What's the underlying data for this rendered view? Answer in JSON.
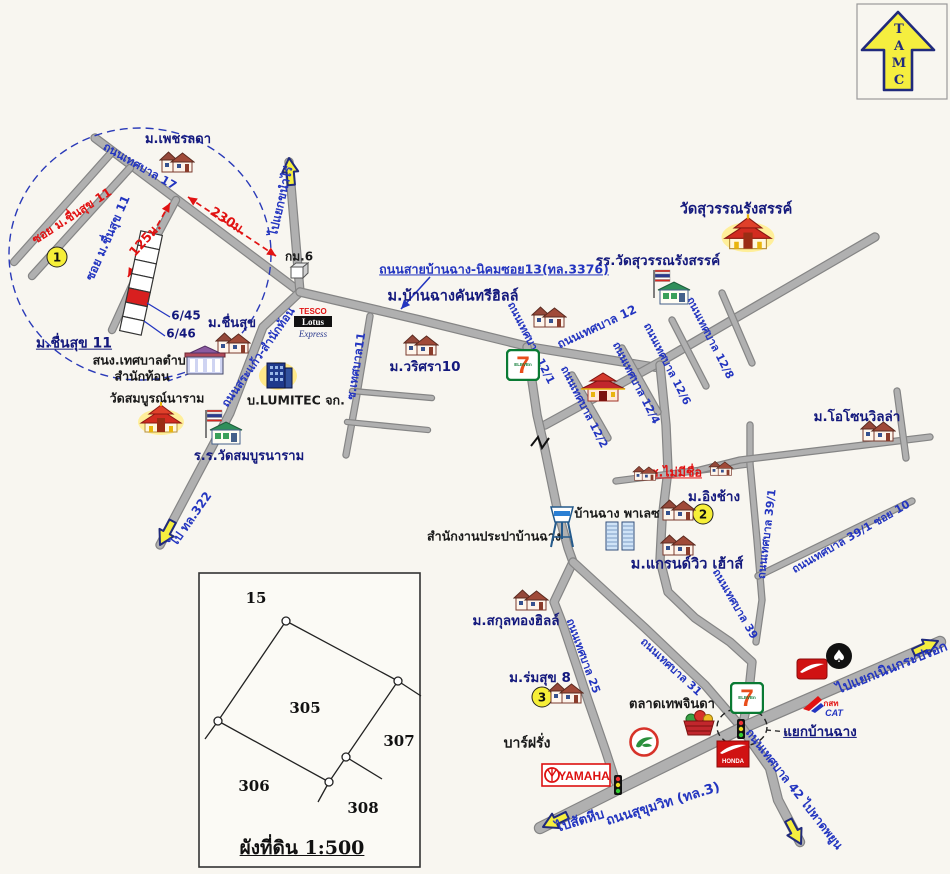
{
  "page": {
    "background": "#f8f6f0",
    "width": 950,
    "height": 874
  },
  "colors": {
    "navy": "#14197d",
    "blue": "#2335c0",
    "red": "#e11212",
    "black": "#1a1a1a",
    "road_fill": "#b0b0b0",
    "road_casing": "#858585",
    "arrow_yellow": "#f5ee3f",
    "arrow_outline": "#202a7c",
    "circle_dash": "#2a3ab8",
    "badge_yellow": "#f6ef38"
  },
  "tamc_logo": {
    "letters": [
      "T",
      "A",
      "M",
      "C"
    ]
  },
  "map": {
    "detail_circle": {
      "cx": 140,
      "cy": 254,
      "rx": 131,
      "ry": 126
    },
    "junction_circle": {
      "cx": 742,
      "cy": 727,
      "rx": 25,
      "ry": 19
    },
    "roads": [
      {
        "pts": [
          [
            95,
            138
          ],
          [
            300,
            292
          ]
        ]
      },
      {
        "pts": [
          [
            300,
            292
          ],
          [
            289,
            162
          ]
        ]
      },
      {
        "pts": [
          [
            300,
            292
          ],
          [
            263,
            327
          ],
          [
            230,
            413
          ],
          [
            160,
            545
          ]
        ]
      },
      {
        "pts": [
          [
            300,
            292
          ],
          [
            420,
            320
          ],
          [
            530,
            347
          ],
          [
            660,
            368
          ]
        ]
      },
      {
        "pts": [
          [
            545,
            425
          ],
          [
            660,
            362
          ],
          [
            875,
            237
          ]
        ]
      },
      {
        "pts": [
          [
            660,
            365
          ],
          [
            666,
            425
          ],
          [
            668,
            470
          ],
          [
            662,
            520
          ],
          [
            660,
            560
          ],
          [
            668,
            592
          ],
          [
            695,
            618
          ],
          [
            730,
            642
          ],
          [
            752,
            662
          ],
          [
            748,
            700
          ],
          [
            742,
            728
          ]
        ]
      },
      {
        "pts": [
          [
            572,
            375
          ],
          [
            608,
            438
          ]
        ],
        "w": 5
      },
      {
        "pts": [
          [
            622,
            348
          ],
          [
            658,
            412
          ]
        ],
        "w": 5
      },
      {
        "pts": [
          [
            672,
            320
          ],
          [
            706,
            386
          ]
        ],
        "w": 5
      },
      {
        "pts": [
          [
            722,
            293
          ],
          [
            752,
            363
          ]
        ],
        "w": 5
      },
      {
        "pts": [
          [
            616,
            481
          ],
          [
            748,
            464
          ]
        ],
        "w": 5
      },
      {
        "pts": [
          [
            750,
            425
          ],
          [
            750,
            464
          ],
          [
            757,
            540
          ],
          [
            762,
            600
          ],
          [
            756,
            642
          ]
        ],
        "w": 5
      },
      {
        "pts": [
          [
            700,
            470
          ],
          [
            740,
            460
          ],
          [
            930,
            437
          ]
        ],
        "w": 5
      },
      {
        "pts": [
          [
            897,
            391
          ],
          [
            906,
            458
          ]
        ],
        "w": 5
      },
      {
        "pts": [
          [
            758,
            576
          ],
          [
            912,
            501
          ]
        ],
        "w": 5
      },
      {
        "pts": [
          [
            370,
            316
          ],
          [
            356,
            400
          ],
          [
            346,
            455
          ]
        ],
        "w": 5
      },
      {
        "pts": [
          [
            352,
            391
          ],
          [
            432,
            398
          ]
        ],
        "w": 4
      },
      {
        "pts": [
          [
            347,
            422
          ],
          [
            428,
            430
          ]
        ],
        "w": 4
      },
      {
        "pts": [
          [
            527,
            347
          ],
          [
            537,
            415
          ],
          [
            545,
            450
          ],
          [
            557,
            508
          ],
          [
            568,
            548
          ],
          [
            573,
            562
          ],
          [
            554,
            602
          ],
          [
            564,
            628
          ],
          [
            588,
            700
          ],
          [
            606,
            752
          ],
          [
            618,
            789
          ]
        ]
      },
      {
        "pts": [
          [
            573,
            562
          ],
          [
            645,
            628
          ],
          [
            705,
            685
          ],
          [
            742,
            728
          ]
        ]
      },
      {
        "pts": [
          [
            540,
            828
          ],
          [
            618,
            789
          ],
          [
            742,
            728
          ],
          [
            940,
            642
          ]
        ],
        "w": 10
      },
      {
        "pts": [
          [
            742,
            728
          ],
          [
            770,
            768
          ],
          [
            778,
            800
          ],
          [
            800,
            842
          ]
        ],
        "w": 8
      },
      {
        "pts": [
          [
            112,
            152
          ],
          [
            14,
            262
          ]
        ],
        "w": 6
      },
      {
        "pts": [
          [
            130,
            168
          ],
          [
            32,
            276
          ]
        ],
        "w": 6
      },
      {
        "pts": [
          [
            176,
            200
          ],
          [
            143,
            262
          ],
          [
            112,
            330
          ]
        ],
        "w": 6
      }
    ],
    "rail_crossing": {
      "path": "M531,446 l7,-9 l4,11 l7,-10",
      "x": 540,
      "y": 447
    },
    "labels": [
      {
        "t": "ม.เพชรลดา",
        "x": 178,
        "y": 140,
        "c": "navy",
        "s": 13
      },
      {
        "t": "ถนนเทศบาล 17",
        "x": 140,
        "y": 166,
        "r": 30,
        "c": "blue",
        "s": 11.5
      },
      {
        "t": "ซอย ม.ชื่นสุข 11",
        "x": 72,
        "y": 216,
        "r": -33,
        "c": "red",
        "s": 12
      },
      {
        "t": "ซอย ม.ชื่นสุข 11",
        "x": 108,
        "y": 238,
        "r": -66,
        "c": "blue",
        "s": 12
      },
      {
        "t": "230ม.",
        "x": 228,
        "y": 222,
        "r": 33,
        "c": "red",
        "s": 13
      },
      {
        "t": "125ม.",
        "x": 146,
        "y": 240,
        "r": -48,
        "c": "red",
        "s": 13
      },
      {
        "t": "6/45",
        "x": 186,
        "y": 316,
        "c": "navy",
        "s": 12
      },
      {
        "t": "6/46",
        "x": 181,
        "y": 334,
        "c": "navy",
        "s": 12
      },
      {
        "t": "ม.ชื่นสุข 11",
        "x": 74,
        "y": 344,
        "c": "navy",
        "s": 14,
        "u": 1
      },
      {
        "t": "กม.6",
        "x": 299,
        "y": 257,
        "c": "black",
        "s": 12
      },
      {
        "t": "ไปแยกขนำไร่",
        "x": 281,
        "y": 201,
        "r": -77,
        "c": "blue",
        "s": 12
      },
      {
        "t": "ถนนสายบ้านฉาง-นิคมซอย13(ทล.3376)",
        "x": 494,
        "y": 269,
        "c": "blue",
        "s": 12.5,
        "u": 1
      },
      {
        "t": "ม.บ้านฉางคันทรีฮิลล์",
        "x": 453,
        "y": 297,
        "c": "navy",
        "s": 14.5
      },
      {
        "t": "ม.ชื่นสุข",
        "x": 232,
        "y": 324,
        "c": "navy",
        "s": 13
      },
      {
        "t": "สนง.เทศบาลตำบล",
        "x": 143,
        "y": 360,
        "c": "black",
        "s": 12.5
      },
      {
        "t": "สำนักท้อน",
        "x": 142,
        "y": 376,
        "c": "black",
        "s": 12.5
      },
      {
        "t": "วัดสมบูรณ์นาราม",
        "x": 157,
        "y": 398,
        "c": "black",
        "s": 12.5
      },
      {
        "t": "ร.ร.วัดสมบูรนาราม",
        "x": 249,
        "y": 457,
        "c": "navy",
        "s": 13
      },
      {
        "t": "บ.LUMITEC จก.",
        "x": 296,
        "y": 400,
        "c": "black",
        "s": 12.5
      },
      {
        "t": "ถนนสระแก้ว-สำนักท้อน",
        "x": 258,
        "y": 357,
        "r": -55,
        "c": "blue",
        "s": 11.5
      },
      {
        "t": "ซ.เทศบาล11",
        "x": 356,
        "y": 366,
        "r": -81,
        "c": "blue",
        "s": 11.5
      },
      {
        "t": "ม.วริศรา10",
        "x": 425,
        "y": 367,
        "c": "navy",
        "s": 13.5
      },
      {
        "t": "ไป ทล.322",
        "x": 191,
        "y": 519,
        "r": -55,
        "c": "blue",
        "s": 12
      },
      {
        "t": "วัดสุวรรณรังสรรค์",
        "x": 736,
        "y": 210,
        "c": "navy",
        "s": 14.5
      },
      {
        "t": "รร.วัดสุวรรณรังสรรค์",
        "x": 658,
        "y": 261,
        "c": "navy",
        "s": 13.5
      },
      {
        "t": "ถนนเทศบาล 12",
        "x": 597,
        "y": 327,
        "r": -25,
        "c": "blue",
        "s": 12
      },
      {
        "t": "ถนนเทศบาล 12/1",
        "x": 531,
        "y": 343,
        "r": 63,
        "c": "blue",
        "s": 11
      },
      {
        "t": "ถนนเทศบาล 12/2",
        "x": 584,
        "y": 407,
        "r": 63,
        "c": "blue",
        "s": 11
      },
      {
        "t": "ถนนเทศบาล 12/4",
        "x": 636,
        "y": 383,
        "r": 63,
        "c": "blue",
        "s": 11
      },
      {
        "t": "ถนนเทศบาล 12/6",
        "x": 667,
        "y": 364,
        "r": 63,
        "c": "blue",
        "s": 11
      },
      {
        "t": "ถนนเทศบาล 12/8",
        "x": 710,
        "y": 338,
        "r": 63,
        "c": "blue",
        "s": 11
      },
      {
        "t": "ม.โอโซนวิลล่า",
        "x": 857,
        "y": 417,
        "c": "navy",
        "s": 13.5
      },
      {
        "t": "ซ.ไม่มีชื่อ",
        "x": 676,
        "y": 472,
        "c": "red",
        "s": 12.5,
        "u": 1
      },
      {
        "t": "ม.อิงช้าง",
        "x": 714,
        "y": 497,
        "c": "navy",
        "s": 13.5
      },
      {
        "t": "บ้านฉาง พาเลซ",
        "x": 617,
        "y": 513,
        "c": "black",
        "s": 12.5
      },
      {
        "t": "สำนักงานประปาบ้านฉาง",
        "x": 494,
        "y": 536,
        "c": "black",
        "s": 12.5
      },
      {
        "t": "ม.แกรนด์วิว เฮ้าส์",
        "x": 687,
        "y": 565,
        "c": "navy",
        "s": 14.5
      },
      {
        "t": "ถนนเทศบาล 39/1",
        "x": 767,
        "y": 534,
        "r": -83,
        "c": "blue",
        "s": 11
      },
      {
        "t": "ถนนเทศบาล 39/1 ซอย 10",
        "x": 851,
        "y": 537,
        "r": -30,
        "c": "blue",
        "s": 11
      },
      {
        "t": "ถนนเทศบาล 39",
        "x": 735,
        "y": 604,
        "r": 60,
        "c": "blue",
        "s": 11
      },
      {
        "t": "ถนนเทศบาล 31",
        "x": 671,
        "y": 667,
        "r": 43,
        "c": "blue",
        "s": 11
      },
      {
        "t": "ถนนเทศบาล 25",
        "x": 583,
        "y": 656,
        "r": 70,
        "c": "blue",
        "s": 11
      },
      {
        "t": "ม.สกุลทองฮิลล์",
        "x": 516,
        "y": 621,
        "c": "navy",
        "s": 13.5
      },
      {
        "t": "ม.ร่มสุข 8",
        "x": 540,
        "y": 678,
        "c": "navy",
        "s": 13.5
      },
      {
        "t": "บาร์ฝรั่ง",
        "x": 527,
        "y": 744,
        "c": "black",
        "s": 14
      },
      {
        "t": "ตลาดเทพจินดา",
        "x": 672,
        "y": 705,
        "c": "black",
        "s": 13
      },
      {
        "t": "แยกบ้านฉาง",
        "x": 820,
        "y": 732,
        "c": "navy",
        "s": 13.5,
        "u": 1
      },
      {
        "t": "ไปแยกเนินกระปรอก",
        "x": 892,
        "y": 668,
        "r": -22,
        "c": "blue",
        "s": 13.5
      },
      {
        "t": "ถนนสุขุมวิท (ทล.3)",
        "x": 663,
        "y": 804,
        "r": -17,
        "c": "blue",
        "s": 13.5
      },
      {
        "t": "ไปสัตหีบ",
        "x": 580,
        "y": 821,
        "r": -17,
        "c": "blue",
        "s": 13.5
      },
      {
        "t": "ถนนเทศบาล 42 ไปหาดพยูน",
        "x": 794,
        "y": 789,
        "r": 52,
        "c": "blue",
        "s": 12
      }
    ],
    "circled_numbers": [
      {
        "t": "1",
        "x": 57,
        "y": 257
      },
      {
        "t": "2",
        "x": 703,
        "y": 514
      },
      {
        "t": "3",
        "x": 542,
        "y": 697
      }
    ],
    "icons": [
      {
        "type": "house",
        "x": 177,
        "y": 163
      },
      {
        "type": "house",
        "x": 233,
        "y": 344
      },
      {
        "type": "house",
        "x": 549,
        "y": 318
      },
      {
        "type": "house",
        "x": 421,
        "y": 346
      },
      {
        "type": "house",
        "x": 878,
        "y": 432
      },
      {
        "type": "house",
        "x": 645,
        "y": 474,
        "sc": 0.7
      },
      {
        "type": "house",
        "x": 721,
        "y": 469,
        "sc": 0.7
      },
      {
        "type": "house",
        "x": 678,
        "y": 511
      },
      {
        "type": "house",
        "x": 678,
        "y": 546
      },
      {
        "type": "house",
        "x": 531,
        "y": 601
      },
      {
        "type": "house",
        "x": 566,
        "y": 694
      },
      {
        "type": "temple",
        "x": 161,
        "y": 421
      },
      {
        "type": "temple",
        "x": 748,
        "y": 236,
        "sc": 1.15
      },
      {
        "type": "school",
        "x": 224,
        "y": 430
      },
      {
        "type": "school",
        "x": 672,
        "y": 290
      },
      {
        "type": "office",
        "x": 205,
        "y": 362
      },
      {
        "type": "bldg",
        "x": 278,
        "y": 377
      },
      {
        "type": "tesco",
        "x": 313,
        "y": 326
      },
      {
        "type": "seven",
        "x": 523,
        "y": 367
      },
      {
        "type": "seven",
        "x": 747,
        "y": 700
      },
      {
        "type": "shrine",
        "x": 603,
        "y": 389
      },
      {
        "type": "apartment",
        "x": 620,
        "y": 538
      },
      {
        "type": "watertower",
        "x": 562,
        "y": 529
      },
      {
        "type": "market",
        "x": 699,
        "y": 726
      },
      {
        "type": "bird",
        "x": 644,
        "y": 744
      },
      {
        "type": "yamaha",
        "x": 576,
        "y": 777
      },
      {
        "type": "hondaw",
        "x": 812,
        "y": 671
      },
      {
        "type": "emblem",
        "x": 839,
        "y": 658
      },
      {
        "type": "hondaf",
        "x": 733,
        "y": 756
      },
      {
        "type": "cat",
        "x": 824,
        "y": 709
      },
      {
        "type": "km",
        "x": 299,
        "y": 272
      },
      {
        "type": "tl",
        "x": 741,
        "y": 731
      },
      {
        "type": "tl",
        "x": 618,
        "y": 787
      }
    ],
    "logo_text": {
      "tesco": {
        "t1": "TESCO",
        "t2": "Lotus",
        "t3": "Express"
      },
      "seven": {
        "digit": "7",
        "word": "ELEVEn"
      },
      "yamaha": "YAMAHA",
      "honda": "HONDA",
      "cat": {
        "t1": "กสท",
        "t2": "CAT"
      },
      "emblem_glyph": "♠"
    },
    "yellow_arrows": [
      {
        "x": 289,
        "y": 158,
        "rot": -5
      },
      {
        "x": 160,
        "y": 545,
        "rot": 208
      },
      {
        "x": 543,
        "y": 827,
        "rot": 244
      },
      {
        "x": 938,
        "y": 641,
        "rot": 65
      },
      {
        "x": 801,
        "y": 844,
        "rot": 152
      }
    ],
    "measure_arrows": [
      {
        "x1": 188,
        "y1": 197,
        "x2": 276,
        "y2": 256
      },
      {
        "x1": 170,
        "y1": 203,
        "x2": 128,
        "y2": 277
      }
    ],
    "pointer_arrow": {
      "x1": 430,
      "y1": 277,
      "x2": 401,
      "y2": 309
    },
    "dash_lines": [
      {
        "x1": 168,
        "y1": 381,
        "x2": 197,
        "y2": 371,
        "c": "#2a3ab8"
      },
      {
        "x1": 766,
        "y1": 730,
        "x2": 787,
        "y2": 732,
        "c": "#333333"
      }
    ],
    "plot_strip": {
      "cx": 141,
      "cy": 283,
      "w": 22,
      "h": 102,
      "rot": 12,
      "cells": 7,
      "red_index": 4
    },
    "strip_pointers": [
      {
        "x1": 170,
        "y1": 317,
        "x2": 147,
        "y2": 303
      },
      {
        "x1": 165,
        "y1": 336,
        "x2": 144,
        "y2": 321
      }
    ]
  },
  "diagram": {
    "x": 199,
    "y": 573,
    "w": 221,
    "h": 294,
    "title": "ผังที่ดิน 1:500",
    "title_x": 302,
    "title_y": 848,
    "vertices": [
      [
        286,
        621
      ],
      [
        398,
        681
      ],
      [
        346,
        757
      ],
      [
        329,
        782
      ],
      [
        218,
        721
      ]
    ],
    "extensions": [
      [
        [
          398,
          681
        ],
        [
          421,
          696
        ]
      ],
      [
        [
          218,
          721
        ],
        [
          205,
          739
        ]
      ],
      [
        [
          329,
          782
        ],
        [
          318,
          802
        ]
      ],
      [
        [
          346,
          757
        ],
        [
          382,
          779
        ]
      ]
    ],
    "numbers": [
      {
        "t": "15",
        "x": 256,
        "y": 598
      },
      {
        "t": "305",
        "x": 305,
        "y": 708
      },
      {
        "t": "307",
        "x": 399,
        "y": 741
      },
      {
        "t": "306",
        "x": 254,
        "y": 786
      },
      {
        "t": "308",
        "x": 363,
        "y": 808
      }
    ]
  }
}
